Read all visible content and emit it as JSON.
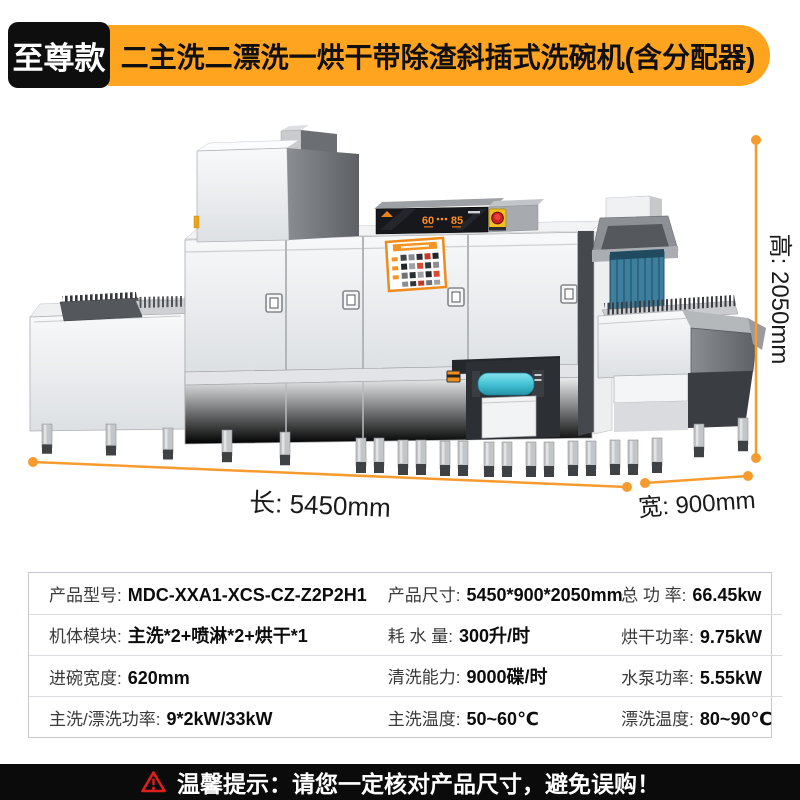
{
  "header": {
    "badge": "至尊款",
    "title": "二主洗二漂洗一烘干带除渣斜插式洗碗机(含分配器)"
  },
  "figure": {
    "dim_length": "长: 5450mm",
    "dim_width": "宽: 900mm",
    "dim_height": "高: 2050mm",
    "panel": {
      "temp_left": "60",
      "temp_right": "85"
    }
  },
  "specs": {
    "rows": [
      [
        {
          "label": "产品型号:",
          "value": "MDC-XXA1-XCS-CZ-Z2P2H1"
        },
        {
          "label": "产品尺寸:",
          "value": "5450*900*2050mm"
        },
        {
          "label": "总 功 率:",
          "value": "66.45kw"
        }
      ],
      [
        {
          "label": "机体模块:",
          "value": "主洗*2+喷淋*2+烘干*1"
        },
        {
          "label": "耗 水 量:",
          "value": "300升/时"
        },
        {
          "label": "烘干功率:",
          "value": "9.75kW"
        }
      ],
      [
        {
          "label": "进碗宽度:",
          "value": "620mm"
        },
        {
          "label": "清洗能力:",
          "value": "9000碟/时"
        },
        {
          "label": "水泵功率:",
          "value": "5.55kW"
        }
      ],
      [
        {
          "label": "主洗/漂洗功率:",
          "value": "9*2kW/33kW"
        },
        {
          "label": "主洗温度:",
          "value": "50~60℃"
        },
        {
          "label": "漂洗温度:",
          "value": "80~90℃"
        }
      ]
    ]
  },
  "footer": {
    "notice": "温馨提示：请您一定核对产品尺寸，避免误购！"
  },
  "colors": {
    "banner_orange": "#ffa41e",
    "dimension_orange": "#f79b2e",
    "warning_red": "#e01e1e",
    "footer_bg": "#0b0b0b",
    "curtain_blue": "#3d7f9c",
    "roller_cyan": "#45c3d6"
  }
}
